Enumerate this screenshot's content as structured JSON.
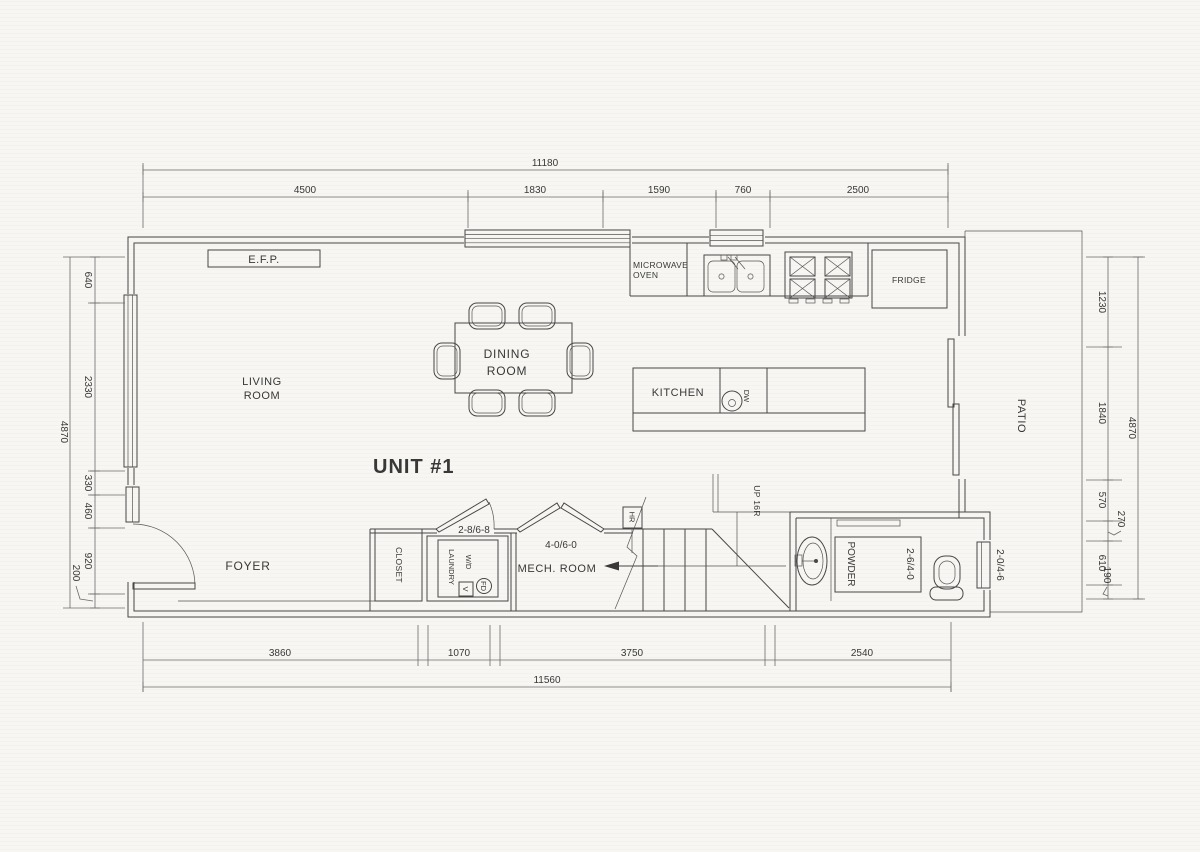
{
  "drawing": {
    "unit_title": "UNIT #1",
    "rooms": {
      "living_line1": "LIVING",
      "living_line2": "ROOM",
      "dining_line1": "DINING",
      "dining_line2": "ROOM",
      "kitchen": "KITCHEN",
      "foyer": "FOYER",
      "closet": "CLOSET",
      "mech_room": "MECH. ROOM",
      "powder": "POWDER",
      "patio": "PATIO",
      "laundry": "LAUNDRY"
    },
    "fixtures": {
      "fireplace": "E.F.P.",
      "microwave_line1": "MICROWAVE",
      "microwave_line2": "OVEN",
      "fridge": "FRIDGE",
      "dishwasher": "DW",
      "washer_dryer": "W/D",
      "floor_drain": "FD",
      "vent": "V",
      "handrail": "HR",
      "stair_note": "UP 16R"
    },
    "door_sizes": {
      "laundry_door": "2-8/6-8",
      "mech_door": "4-0/6-0",
      "powder_door": "2-6/4-0",
      "patio_door": "2-0/4-6"
    },
    "dimensions": {
      "top": {
        "overall": "11180",
        "segments": [
          "4500",
          "1830",
          "1590",
          "760",
          "2500"
        ]
      },
      "bottom": {
        "overall": "11560",
        "segments": [
          "3860",
          "1070",
          "3750",
          "2540"
        ]
      },
      "left": {
        "overall": "4870",
        "segments": [
          "640",
          "2330",
          "330",
          "460",
          "920",
          "200"
        ]
      },
      "right": {
        "overall": "4870",
        "segments": [
          "1230",
          "1840",
          "570",
          "270",
          "610",
          "190"
        ]
      }
    },
    "colors": {
      "paper": "#f7f6f2",
      "line": "#474747",
      "dim_line": "#6b6b6b",
      "text": "#383838"
    }
  }
}
